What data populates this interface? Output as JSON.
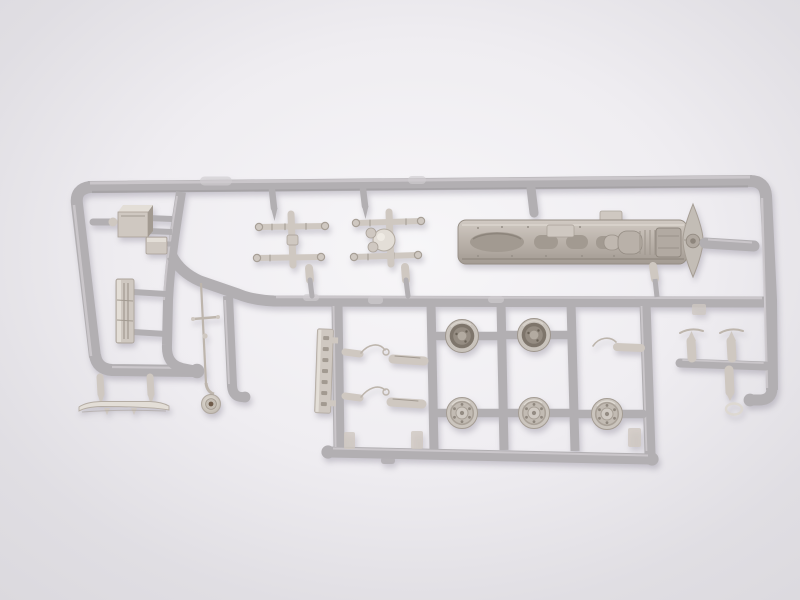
{
  "image": {
    "type": "photograph",
    "description": "Unpainted light-gray injection-molded plastic sprue (parts tree) from a scale truck model kit, lying on a plain pale studio background. The runner frame is rectangular with rounded corners and a stepped middle rail.",
    "alt": "Gray model kit sprue holding truck chassis, five wheels, leaf-spring axle assemblies, cab box, grille, bumper, horn, mirror arms and small detail parts"
  },
  "colors": {
    "background_center": "#f7f6f8",
    "background_mid": "#efedf1",
    "background_edge": "#e0dee3",
    "runner": "#b2afb2",
    "runner_highlight": "#cfccd0",
    "runner_shadow": "#8f8b8e",
    "part": "#cfc8c1",
    "part_light": "#e3ded7",
    "part_dark": "#a29a91",
    "wheel_recess": "#7e756b",
    "wheel_hub": "#b3aba1",
    "horn_center": "#6e5a49",
    "shadow": "rgba(110,104,122,0.30)"
  },
  "inventory": {
    "ladder_chassis_frame": 1,
    "cooling_fan_disc": 1,
    "leaf_spring_axle_assemblies": 2,
    "wheel_hubs_back_side": 2,
    "wheel_faces_front_side": 3,
    "cab_box": 1,
    "bracket_block": 1,
    "radiator_grille": 1,
    "front_bumper": 1,
    "air_horn_with_antenna": 1,
    "ladder_strip": 1,
    "mirror_arm_sets": 2,
    "tow_hook": 1,
    "exhaust_stack_cylinders": 3,
    "tapered_pins": 4
  }
}
